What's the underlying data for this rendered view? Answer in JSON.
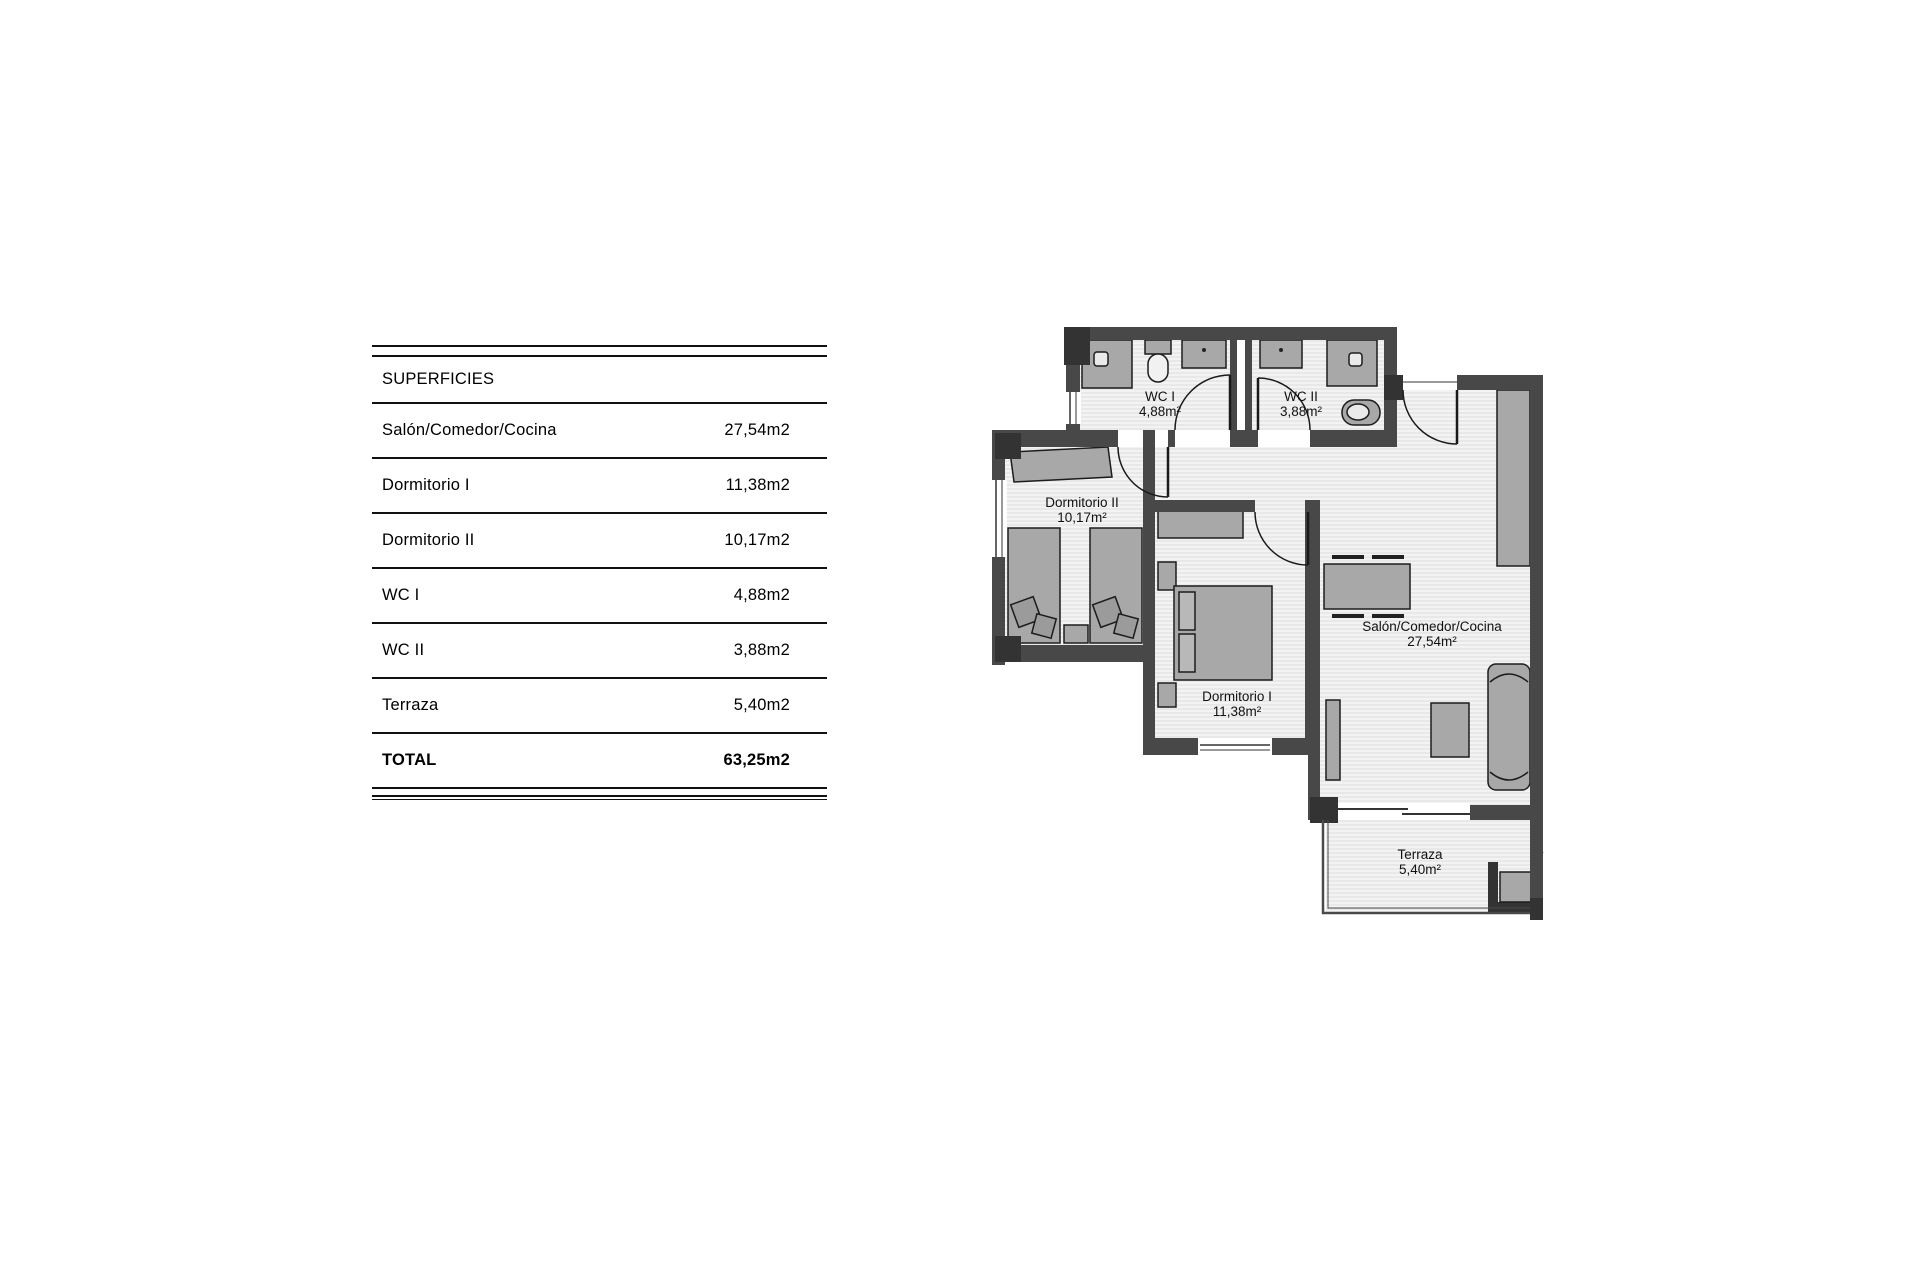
{
  "surfaces_table": {
    "title": "SUPERFICIES",
    "rows": [
      {
        "label": "Salón/Comedor/Cocina",
        "value": "27,54m2"
      },
      {
        "label": "Dormitorio I",
        "value": "11,38m2"
      },
      {
        "label": "Dormitorio II",
        "value": "10,17m2"
      },
      {
        "label": "WC I",
        "value": "4,88m2"
      },
      {
        "label": "WC II",
        "value": "3,88m2"
      },
      {
        "label": "Terraza",
        "value": "5,40m2"
      }
    ],
    "total": {
      "label": "TOTAL",
      "value": "63,25m2"
    }
  },
  "floorplan": {
    "rooms": [
      {
        "id": "wc1",
        "name": "WC I",
        "area": "4,88m²"
      },
      {
        "id": "wc2",
        "name": "WC II",
        "area": "3,88m²"
      },
      {
        "id": "dormitorio2",
        "name": "Dormitorio II",
        "area": "10,17m²"
      },
      {
        "id": "dormitorio1",
        "name": "Dormitorio I",
        "area": "11,38m²"
      },
      {
        "id": "salon",
        "name": "Salón/Comedor/Cocina",
        "area": "27,54m²"
      },
      {
        "id": "terraza",
        "name": "Terraza",
        "area": "5,40m²"
      }
    ],
    "colors": {
      "wall": "#484848",
      "pillar": "#333333",
      "furniture": "#a8a8a8",
      "floor_bg": "#f3f3f3",
      "floor_stripe": "#dcdcdc"
    }
  }
}
